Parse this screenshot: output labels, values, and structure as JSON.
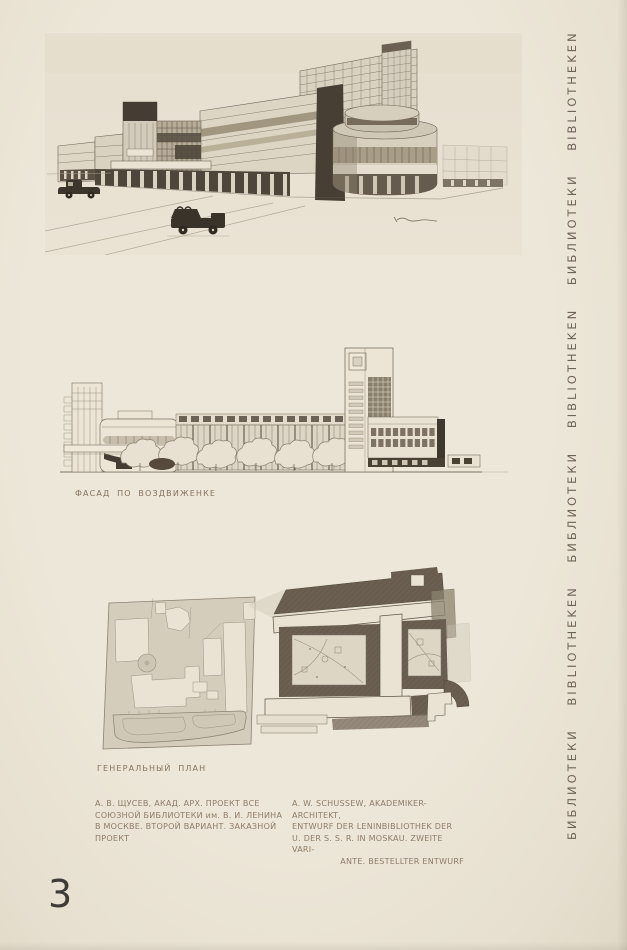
{
  "page": {
    "page_number": "3",
    "edge_title_vertical": "БИБЛИОТЕКИ BIBLIOTHEKEN БИБЛИОТЕКИ BIBLIOTHEKEN БИБЛИОТЕКИ BIBLIOTHEKEN"
  },
  "figures": [
    {
      "id": "perspective",
      "label": "",
      "alt": "Perspective drawing of the library: long constructivist block, tall rear slab with window grid, dark entrance pylons, rounded corner drum with glazing bands, two vintage cars on the street, artist signature at lower right"
    },
    {
      "id": "facade-elevation",
      "label": "ФАСАД ПО ВОЗДВИЖЕНКЕ",
      "alt": "Street elevation: long colonnaded facade with trees along the base, stair tower with slot windows at right, gridded wing with dark end stripe"
    },
    {
      "id": "general-plan",
      "label": "ГЕНЕРАЛЬНЫЙ ПЛАН",
      "alt": "Site plan: light line drawing of existing city blocks with round plaza and garden at left, dark hatched new library complex with two courtyards and a rounded corner at right"
    }
  ],
  "captions": {
    "russian": {
      "lines": [
        "А. В. ЩУСЕВ, АКАД. АРХ. ПРОЕКТ ВСЕ",
        "СОЮЗНОЙ БИБЛИОТЕКИ им. В. И. ЛЕНИНА",
        "В МОСКВЕ. ВТОРОЙ ВАРИАНТ. ЗАКАЗНОЙ",
        "ПРОЕКТ"
      ]
    },
    "german": {
      "lines": [
        "A. W. SCHUSSEW, AKADEMIKER-ARCHITEKT,",
        "ENTWURF DER LENINBIBLIOTHEK DER",
        "U. DER S. S. R. IN MOSKAU. ZWEITE VARI-",
        "ANTE. BESTELLTER ENTWURF"
      ]
    }
  },
  "colors": {
    "paper": "#eae3d5",
    "caption_ink": "#8d7c67",
    "drawing_line": "#6f6456",
    "drawing_dark": "#423a30",
    "plan_dark": "#6a5f50",
    "page_number_ink": "#3e3b36"
  }
}
